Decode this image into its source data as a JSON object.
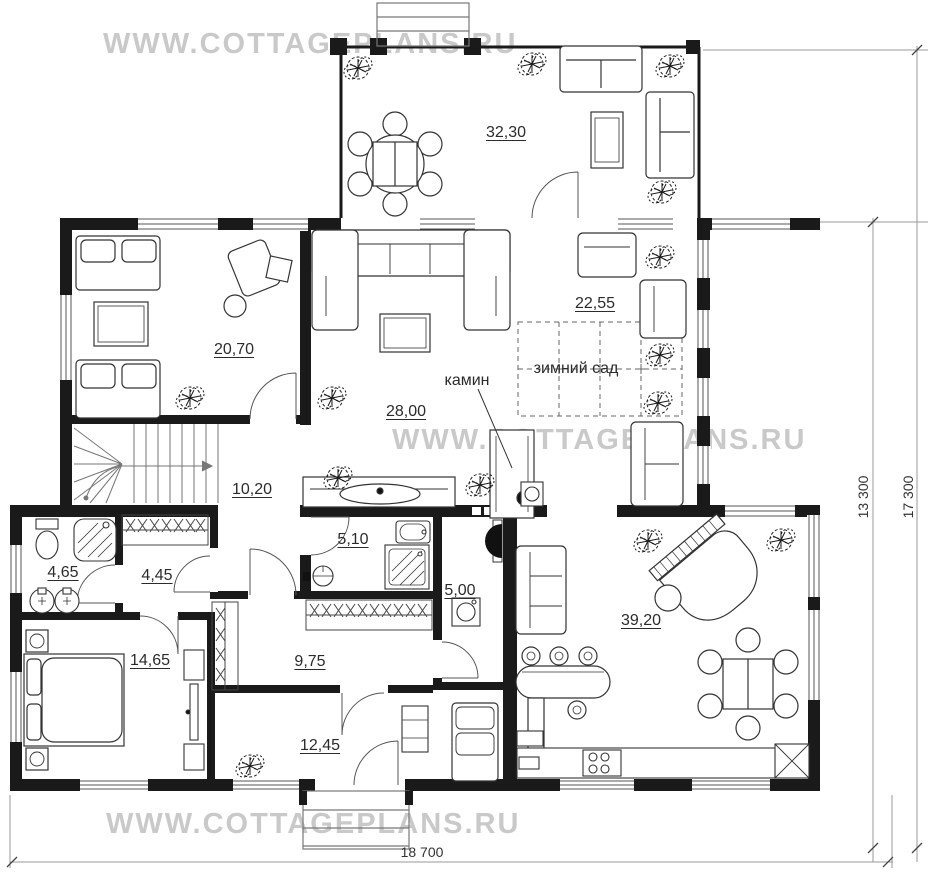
{
  "watermark": {
    "text": "WWW.COTTAGEPLANS.RU",
    "color": "#c9c9c9"
  },
  "rooms": {
    "terrace": "32,30",
    "lounge": "20,70",
    "winter_garden": "22,55",
    "living_room": "28,00",
    "hall": "10,20",
    "bathroom": "5,10",
    "shower_room": "4,65",
    "wardrobe": "4,45",
    "utility": "5,00",
    "bedroom": "14,65",
    "corridor": "9,75",
    "entry_hall": "12,45",
    "great_room": "39,20"
  },
  "annotations": {
    "winter_garden_label": "зимний сад",
    "fireplace_label": "камин"
  },
  "dimensions": {
    "overall_width": "18 700",
    "main_depth": "13 300",
    "overall_depth": "17 300"
  },
  "colors": {
    "wall": "#1a1a1a",
    "line": "#3a3a3a",
    "dim_line": "#888888"
  }
}
